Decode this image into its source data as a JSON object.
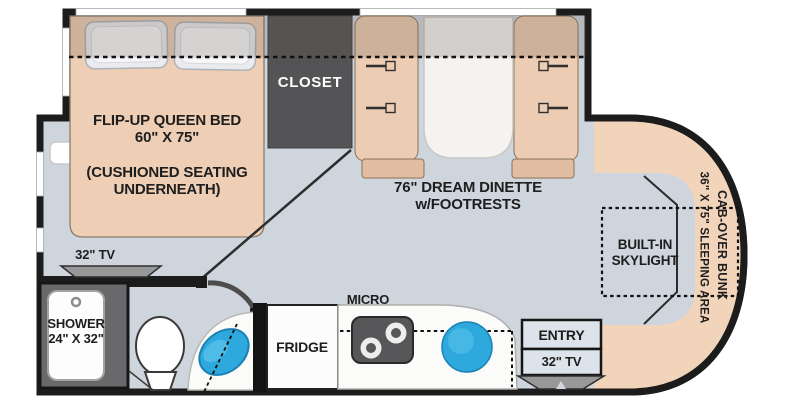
{
  "floorplan": {
    "bedroom": {
      "bed_title": "FLIP-UP QUEEN BED",
      "bed_size": "60\" X 75\"",
      "bed_note1": "(CUSHIONED SEATING",
      "bed_note2": "UNDERNEATH)",
      "tv_label": "32\" TV",
      "closet_label": "CLOSET"
    },
    "bathroom": {
      "shower_label": "SHOWER",
      "shower_size": "24\" X 32\""
    },
    "kitchen": {
      "micro_label": "MICRO",
      "fridge_label": "FRIDGE"
    },
    "dinette": {
      "title": "76\" DREAM DINETTE",
      "subtitle": "w/FOOTRESTS"
    },
    "entry": {
      "entry_label": "ENTRY",
      "tv_label": "32\" TV"
    },
    "cab": {
      "skylight_line1": "BUILT-IN",
      "skylight_line2": "SKYLIGHT",
      "bunk_label": "CAB-OVER BUNK",
      "bunk_size": "36\" X 75\" SLEEPING AREA"
    },
    "colors": {
      "floor": "#ced5dd",
      "wall": "#1c1c1c",
      "upholstery_tan": "#eeceb4",
      "cab_tan": "#f2d4ba",
      "closet_gray": "#545457",
      "sink_blue": "#2ea9de"
    }
  }
}
